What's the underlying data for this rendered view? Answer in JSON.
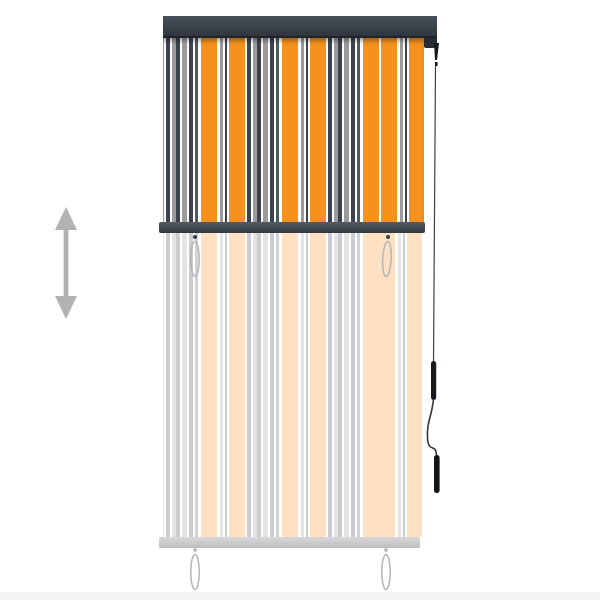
{
  "image": {
    "kind": "product-photo",
    "subject": "outdoor vertical roller blind, half extended, with striped fabric, anthracite cassette, pull-cord wand and hanging cord loops",
    "text_content": "none"
  },
  "colors": {
    "page_bg": "#ffffff",
    "cassette_top": "#2e343c",
    "cassette_body": "#3a414a",
    "cassette_tab": "#272c33",
    "mid_bar": "#3f454d",
    "bottom_bar": "#c7c7ca",
    "orange": "#f6911e",
    "white": "#fefefe",
    "gray": "#9b9b9b",
    "navy": "#3d434e",
    "teal": "#4c5b5b",
    "arrow": "#b2b2b2",
    "cord": "#3f4144",
    "wand": "#17191c",
    "handle": "#121417",
    "loop": "#b4b4b8",
    "loop_dot": "#3a3f45",
    "fade_opacity": "0.27"
  },
  "stripes": {
    "direction": "vertical",
    "unit_px": 81,
    "offset_px": -43,
    "segments": [
      [
        "orange",
        16
      ],
      [
        "white",
        3
      ],
      [
        "gray",
        3
      ],
      [
        "white",
        2
      ],
      [
        "navy",
        2
      ],
      [
        "white",
        2
      ],
      [
        "orange",
        16
      ],
      [
        "white",
        2
      ],
      [
        "navy",
        4
      ],
      [
        "white",
        2
      ],
      [
        "gray",
        4
      ],
      [
        "navy",
        4
      ],
      [
        "white",
        2
      ],
      [
        "gray",
        5
      ],
      [
        "white",
        2
      ],
      [
        "navy",
        4
      ],
      [
        "white",
        2
      ],
      [
        "teal",
        3
      ],
      [
        "white",
        3
      ]
    ]
  },
  "parts": {
    "arrow": "vertical extension indicator arrow",
    "cassette": "anthracite roller cassette",
    "upper_fabric": "extended striped fabric (solid)",
    "mid_bar": "anthracite bottom rail at current extension",
    "faded_fabric": "ghosted fabric showing full drop length",
    "bottom_bar": "ghosted bottom rail at full drop",
    "cord": "operating cord with wand and handle",
    "loops": "pull-cord loops (mid left/right, bottom left/right)"
  }
}
